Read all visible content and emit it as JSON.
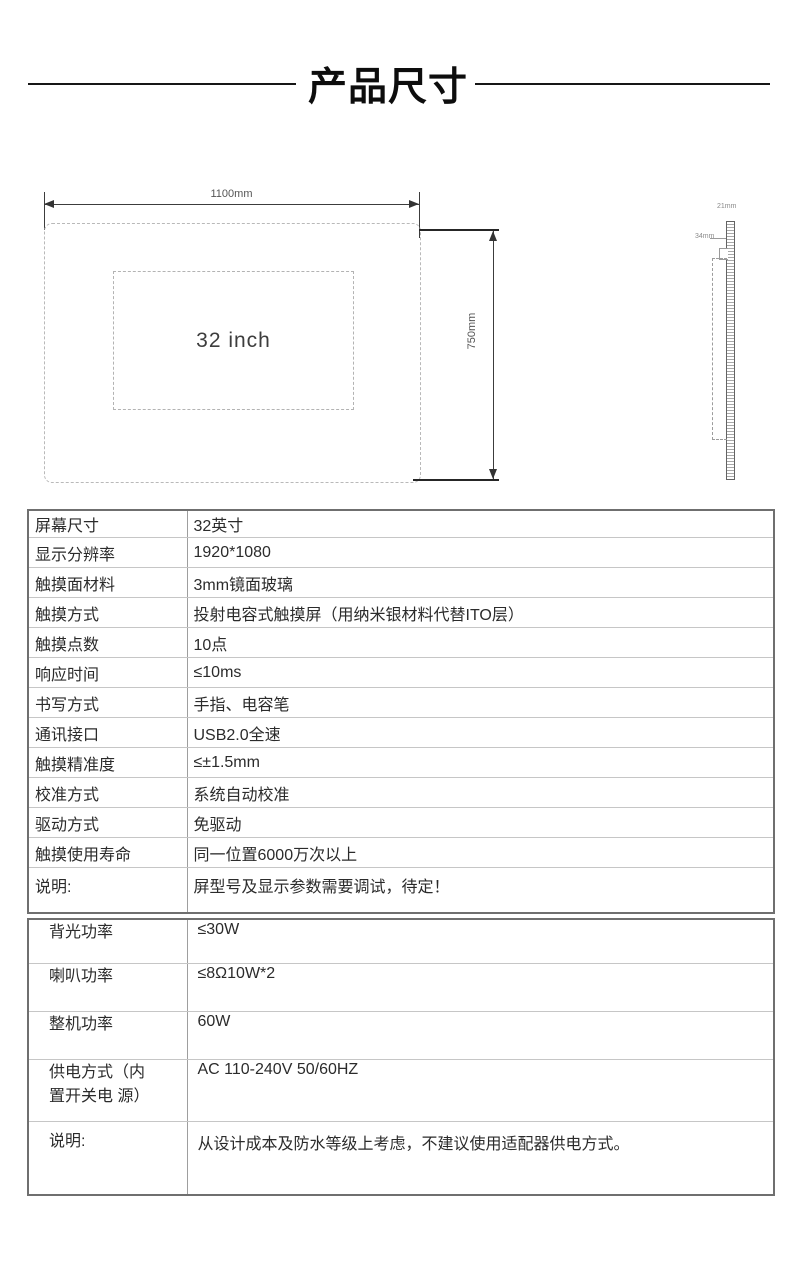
{
  "header": {
    "title": "产品尺寸"
  },
  "diagram": {
    "front_view": {
      "width_dim": "1100mm",
      "height_dim": "750mm",
      "screen_size": "32 inch"
    },
    "side_view": {
      "top_dim": "21mm",
      "side_dim": "34mm"
    }
  },
  "spec_table": {
    "rows": [
      {
        "label": "屏幕尺寸",
        "value": "32英寸"
      },
      {
        "label": "显示分辨率",
        "value": "1920*1080"
      },
      {
        "label": "触摸面材料",
        "value": "3mm镜面玻璃"
      },
      {
        "label": "触摸方式",
        "value": "投射电容式触摸屏（用纳米银材料代替ITO层）"
      },
      {
        "label": "触摸点数",
        "value": "10点"
      },
      {
        "label": "响应时间",
        "value": "≤10ms"
      },
      {
        "label": "书写方式",
        "value": "手指、电容笔"
      },
      {
        "label": "通讯接口",
        "value": "USB2.0全速"
      },
      {
        "label": "触摸精准度",
        "value": "≤±1.5mm"
      },
      {
        "label": "校准方式",
        "value": "系统自动校准"
      },
      {
        "label": "驱动方式",
        "value": "免驱动"
      },
      {
        "label": "触摸使用寿命",
        "value": "同一位置6000万次以上"
      },
      {
        "label": "说明:",
        "value": "屏型号及显示参数需要调试，待定！"
      }
    ]
  },
  "power_table": {
    "rows": [
      {
        "label": "背光功率",
        "value": "≤30W"
      },
      {
        "label": "喇叭功率",
        "value": "≤8Ω10W*2"
      },
      {
        "label": "整机功率",
        "value": "60W"
      },
      {
        "label": "供电方式（内\n置开关电 源）",
        "value": "AC 110-240V 50/60HZ"
      },
      {
        "label": "说明:",
        "value": "从设计成本及防水等级上考虑，不建议使用适配器供电方式。"
      }
    ]
  }
}
